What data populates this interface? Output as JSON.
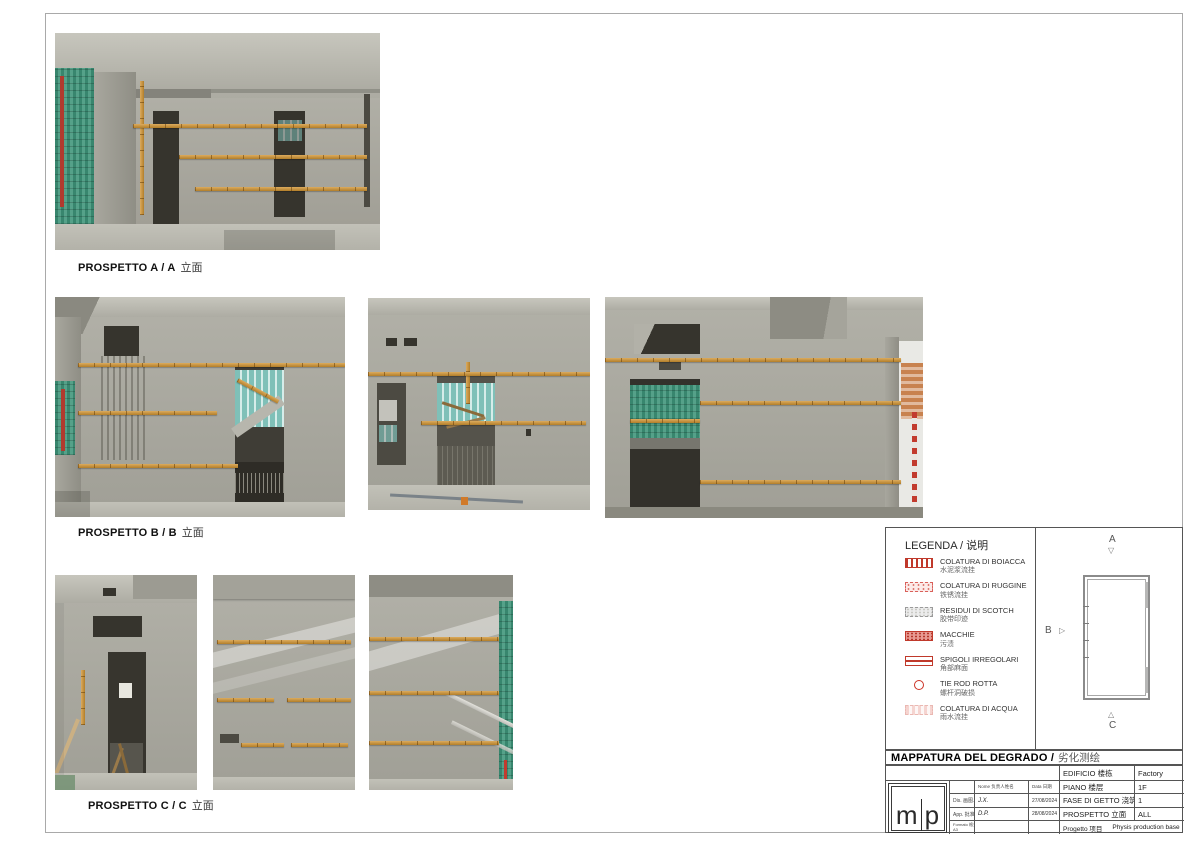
{
  "captions": {
    "a": {
      "name": "PROSPETTO A / A",
      "zh": "立面"
    },
    "b": {
      "name": "PROSPETTO B / B",
      "zh": "立面"
    },
    "c": {
      "name": "PROSPETTO C / C",
      "zh": "立面"
    }
  },
  "legend": {
    "title": "LEGENDA / 说明",
    "items": [
      {
        "it": "COLATURA DI BOIACCA",
        "zh": "水泥浆流挂"
      },
      {
        "it": "COLATURA DI RUGGINE",
        "zh": "铁锈流挂"
      },
      {
        "it": "RESIDUI DI SCOTCH",
        "zh": "胶带印迹"
      },
      {
        "it": "MACCHIE",
        "zh": "污渍"
      },
      {
        "it": "SPIGOLI IRREGOLARI",
        "zh": "角部麻面"
      },
      {
        "it": "TIE ROD ROTTA",
        "zh": "螺杆洞破损"
      },
      {
        "it": "COLATURA DI ACQUA",
        "zh": "雨水流挂"
      }
    ],
    "accent_color": "#c0392b"
  },
  "plan": {
    "a": "A",
    "b": "B",
    "c": "C",
    "arrow_a": "▽",
    "arrow_b": "▷",
    "arrow_c": "△"
  },
  "titleblock": {
    "title_it": "MAPPATURA DEL DEGRADO /",
    "title_zh": "劣化测绘",
    "logo": {
      "left": "m",
      "right": "p"
    },
    "info": {
      "rows": [
        {
          "label": "EDIFICIO 楼栋",
          "value": "Factory"
        },
        {
          "label": "PIANO 楼层",
          "value": "1F"
        },
        {
          "label": "FASE DI GETTO 浇筑阶段",
          "value": "1"
        },
        {
          "label": "PROSPETTO 立面",
          "value": "ALL"
        }
      ],
      "progetto_label": "Progetto 项目",
      "progetto_value": "Physis production base"
    },
    "small": {
      "nome_header": "Nome 负责人姓名",
      "data_header": "Data 日期",
      "rows": [
        {
          "label": "Dis. 画图人",
          "name": "J.X.",
          "date": "27/08/2024"
        },
        {
          "label": "App. 批准人",
          "name": "D.P.",
          "date": "28/08/2024"
        }
      ],
      "formato_label": "Formato 格式",
      "formato_value": "A3"
    }
  }
}
